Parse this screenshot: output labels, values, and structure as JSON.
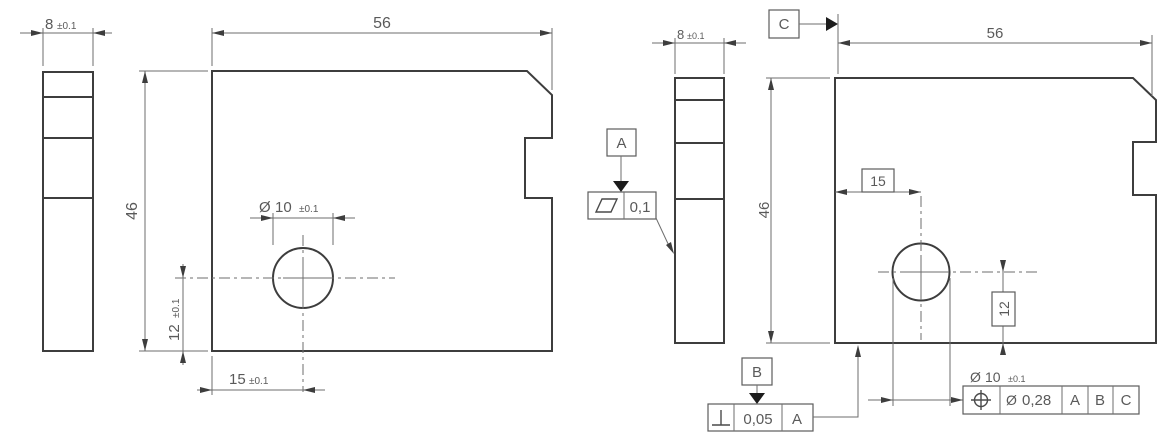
{
  "colors": {
    "background": "#ffffff",
    "part_outline": "#3d3d3d",
    "dimension_line": "#6e6e6e",
    "text": "#5a5a5a"
  },
  "left_drawing": {
    "thickness_dim": {
      "value": "8",
      "tol": "±0.1"
    },
    "width_dim": "56",
    "height_dim": "46",
    "hole_dia_dim": {
      "symbol": "Ø",
      "value": "10",
      "tol": "±0.1"
    },
    "hole_x_dim": {
      "value": "15",
      "tol": "±0.1"
    },
    "hole_y_dim": {
      "value": "12",
      "tol": "±0.1"
    }
  },
  "right_drawing": {
    "thickness_dim": {
      "value": "8",
      "tol": "±0.1"
    },
    "width_dim": "56",
    "height_dim": "46",
    "hole_x_basic": "15",
    "hole_y_basic": "12",
    "hole_dia_dim": {
      "symbol": "Ø",
      "value": "10",
      "tol": "±0.1"
    },
    "datums": {
      "a": "A",
      "b": "B",
      "c": "C"
    },
    "flatness_fcf": {
      "symbol_name": "flatness",
      "value": "0,1"
    },
    "perpendicularity_fcf": {
      "symbol_name": "perpendicularity",
      "value": "0,05",
      "datum": "A"
    },
    "position_fcf": {
      "symbol_name": "position",
      "dia": "Ø",
      "value": "0,28",
      "datum_1": "A",
      "datum_2": "B",
      "datum_3": "C"
    }
  }
}
